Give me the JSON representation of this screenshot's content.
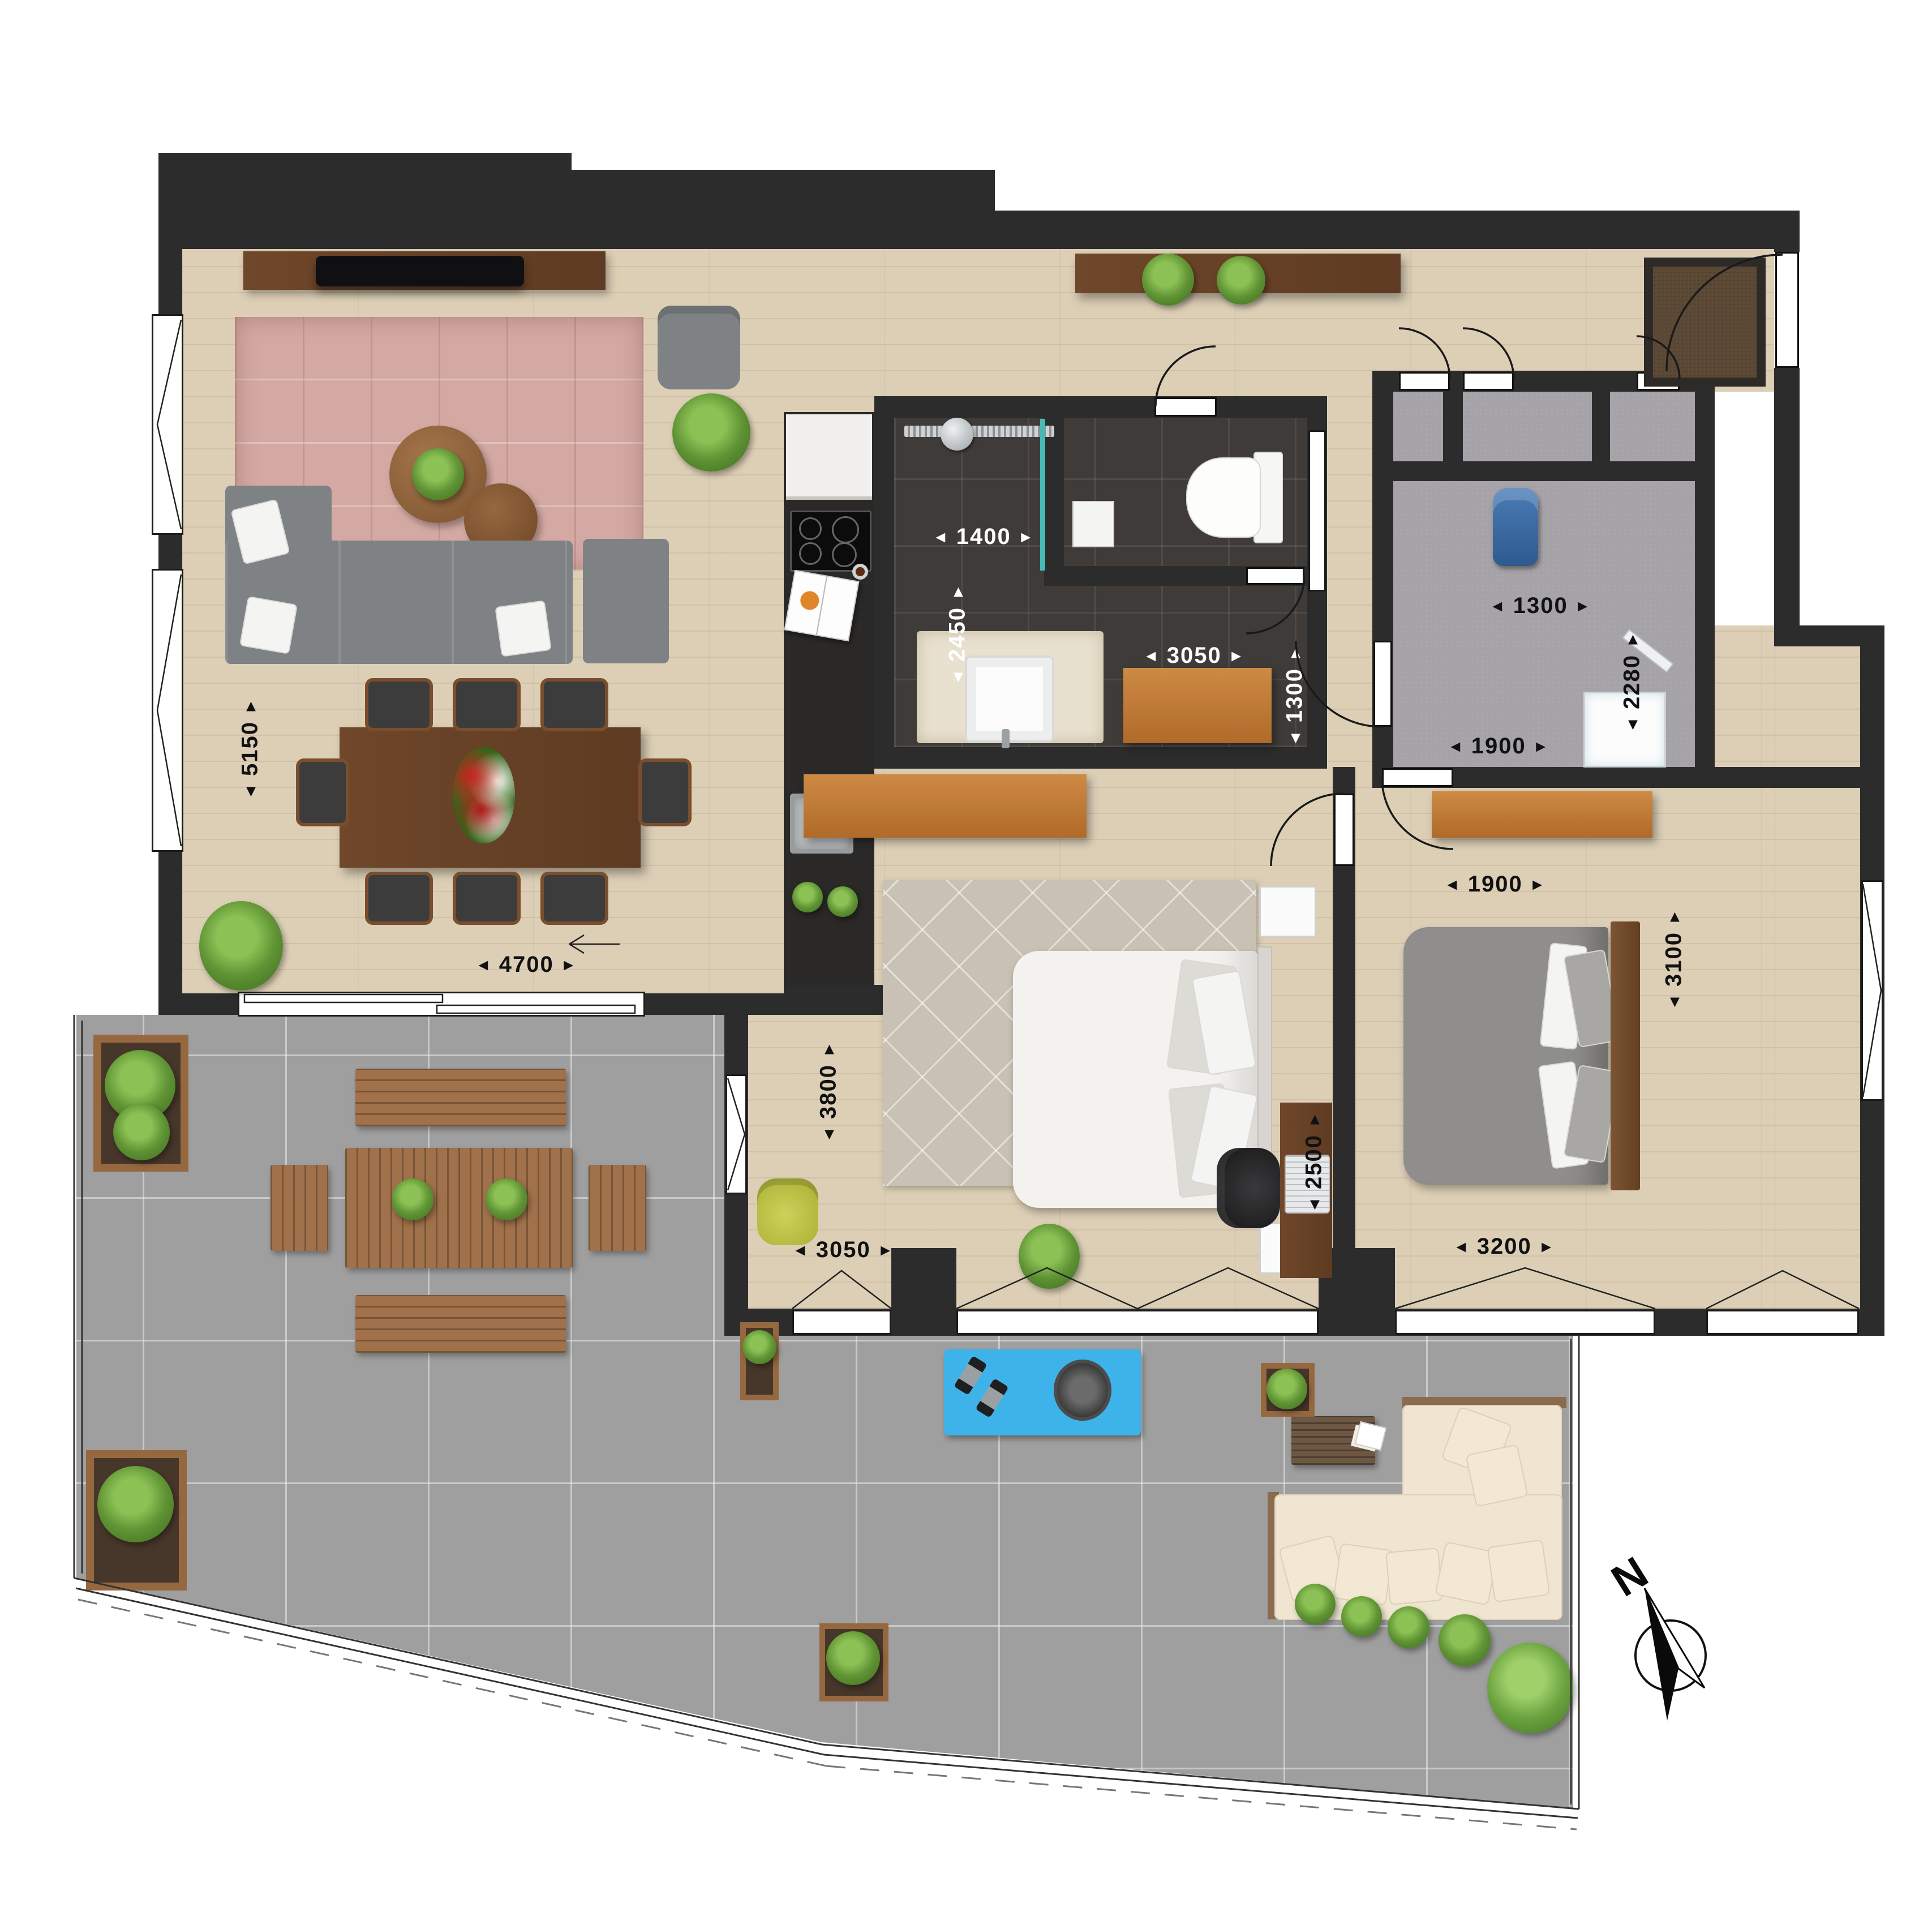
{
  "compass": {
    "label": "N"
  },
  "dims": {
    "living_depth": "5150",
    "living_width": "4700",
    "shower_width": "1400",
    "bath_depth": "2450",
    "bath_width": "3050",
    "bath_right_depth": "1300",
    "storage_width": "1300",
    "storage_depth": "2280",
    "storage_bottom_width": "1900",
    "bed2_wardrobe_width": "1900",
    "bed2_depth": "3100",
    "bed2_width": "3200",
    "master_depth": "3800",
    "master_width": "3050",
    "master_nook_depth": "2500"
  },
  "colors": {
    "wall": "#2c2c2c",
    "wood_floor": "#dccfb6",
    "dark_tile": "#3f3b39",
    "carpet": "#a5a2a8",
    "terrace_tile": "#9f9f9f",
    "glass_teal": "#49b9b5",
    "yoga_mat_blue": "#3eb3ea",
    "cabinet_wood": "#c07936",
    "furniture_wood": "#8a5f3c"
  }
}
